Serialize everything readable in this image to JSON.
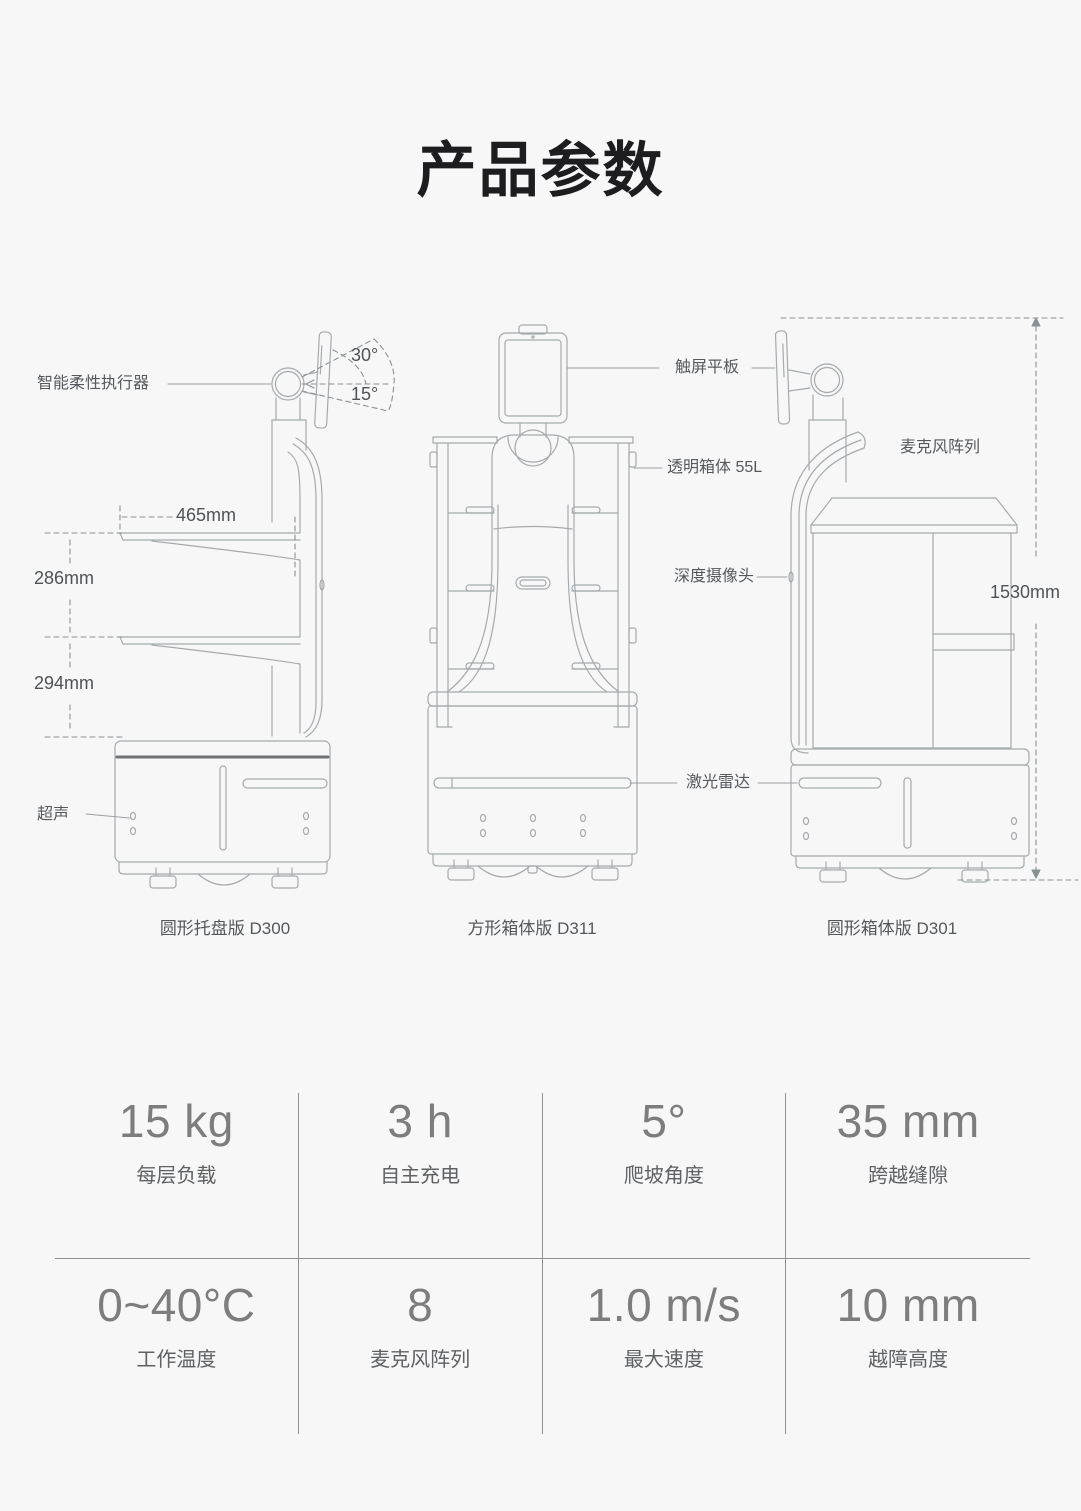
{
  "page": {
    "title": "产品参数",
    "background": "#f7f7f8"
  },
  "diagram": {
    "line_color": "#a6aaac",
    "dash_color": "#8b9093",
    "robots": [
      {
        "id": "D300",
        "caption": "圆形托盘版 D300"
      },
      {
        "id": "D311",
        "caption": "方形箱体版 D311"
      },
      {
        "id": "D301",
        "caption": "圆形箱体版 D301"
      }
    ],
    "callouts": {
      "actuator": "智能柔性执行器",
      "ultrasonic": "超声",
      "touchscreen": "触屏平板",
      "transparent_box": "透明箱体 55L",
      "depth_camera": "深度摄像头",
      "lidar": "激光雷达",
      "mic_array": "麦克风阵列"
    },
    "dimensions": {
      "tray_width": "465mm",
      "tray_gap_upper": "286mm",
      "tray_gap_lower": "294mm",
      "total_height": "1530mm",
      "screen_tilt_up": "30°",
      "screen_tilt_down": "15°"
    }
  },
  "specs": {
    "rows": [
      [
        {
          "value": "15 kg",
          "label": "每层负载"
        },
        {
          "value": "3 h",
          "label": "自主充电"
        },
        {
          "value": "5°",
          "label": "爬坡角度"
        },
        {
          "value": "35 mm",
          "label": "跨越缝隙"
        }
      ],
      [
        {
          "value": "0~40°C",
          "label": "工作温度"
        },
        {
          "value": "8",
          "label": "麦克风阵列"
        },
        {
          "value": "1.0 m/s",
          "label": "最大速度"
        },
        {
          "value": "10 mm",
          "label": "越障高度"
        }
      ]
    ]
  }
}
